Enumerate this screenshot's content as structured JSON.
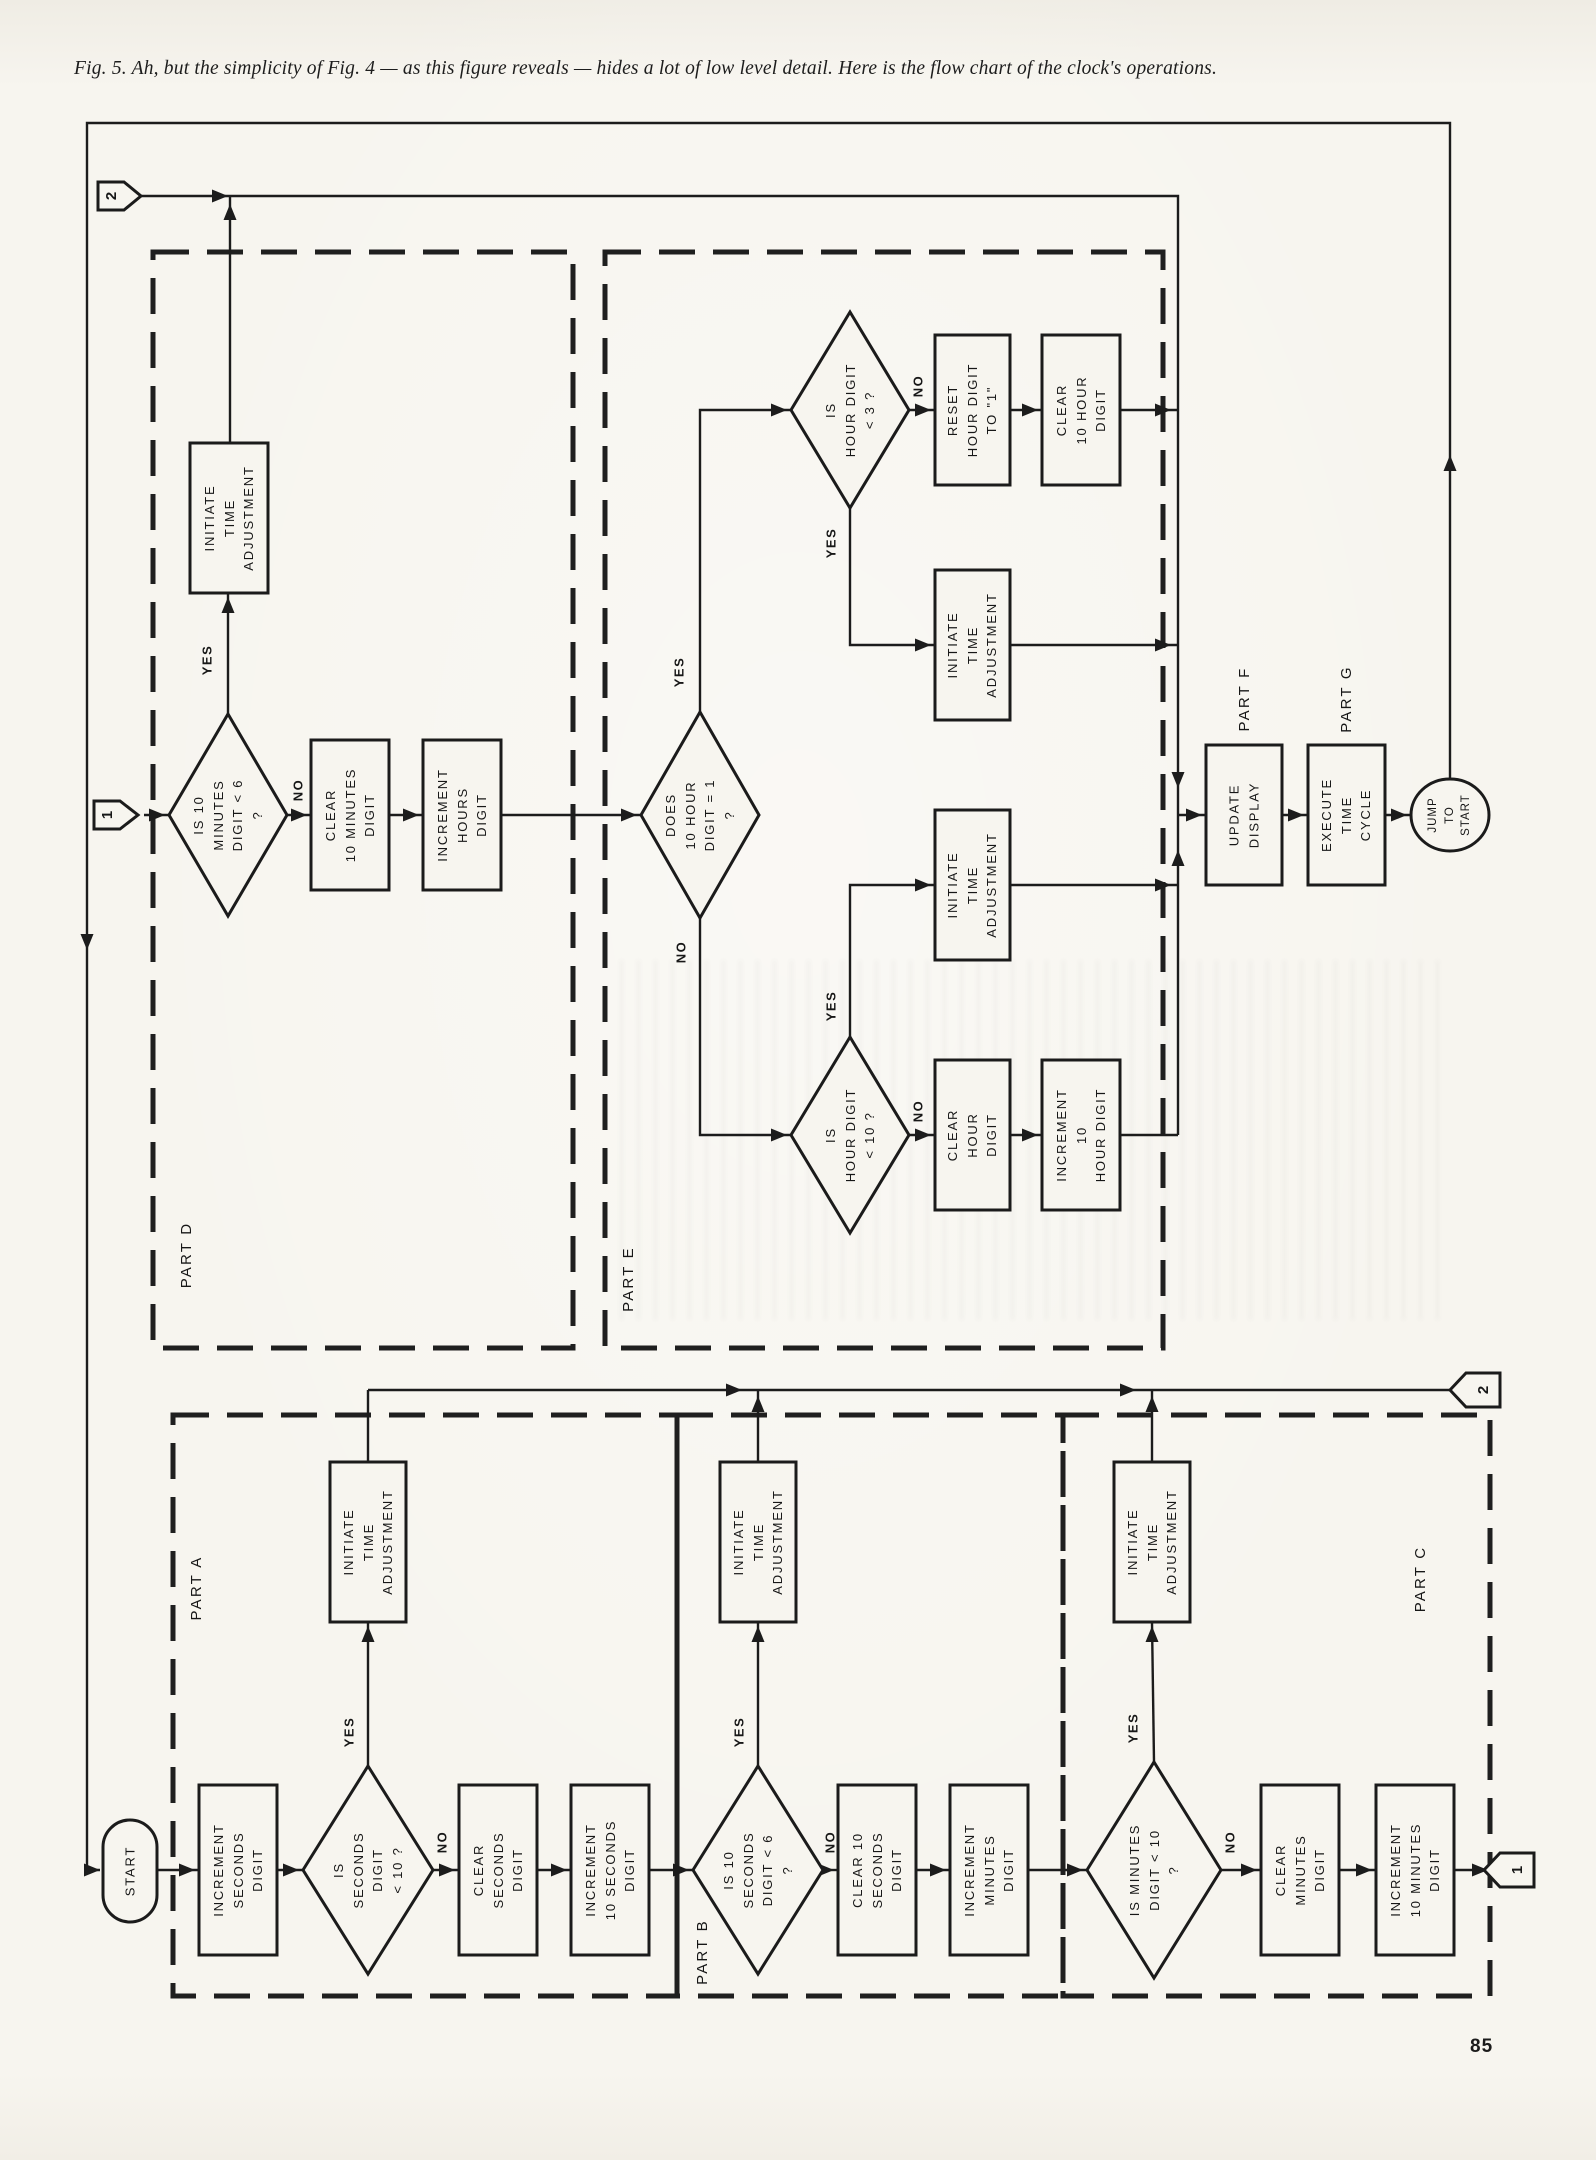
{
  "caption": "Fig. 5. Ah, but the simplicity of Fig. 4 — as this figure reveals — hides a lot of low level detail. Here is the flow chart of the clock's operations.",
  "page_number": "85",
  "decision_labels": {
    "yes": "YES",
    "no": "NO"
  },
  "connectors": {
    "c1": "1",
    "c2": "2"
  },
  "parts": {
    "a": "PART A",
    "b": "PART B",
    "c": "PART C",
    "d": "PART D",
    "e": "PART E",
    "f": "PART F",
    "g": "PART G"
  },
  "nodes": {
    "start": "START",
    "initiate_time_adjustment": "INITIATE\nTIME\nADJUSTMENT",
    "increment_seconds": "INCREMENT\nSECONDS\nDIGIT",
    "is_seconds_lt_10": "IS\nSECONDS\nDIGIT\n< 10 ?",
    "clear_seconds": "CLEAR\nSECONDS\nDIGIT",
    "increment_10_seconds": "INCREMENT\n10 SECONDS\nDIGIT",
    "is_10_seconds_lt_6": "IS 10\nSECONDS\nDIGIT < 6\n?",
    "clear_10_seconds": "CLEAR 10\nSECONDS\nDIGIT",
    "increment_minutes": "INCREMENT\nMINUTES\nDIGIT",
    "is_minutes_lt_10": "IS MINUTES\nDIGIT < 10\n?",
    "clear_minutes": "CLEAR\nMINUTES\nDIGIT",
    "increment_10_minutes": "INCREMENT\n10 MINUTES\nDIGIT",
    "is_10_minutes_lt_6": "IS 10\nMINUTES\nDIGIT < 6\n?",
    "clear_10_minutes": "CLEAR\n10 MINUTES\nDIGIT",
    "increment_hours": "INCREMENT\nHOURS\nDIGIT",
    "does_10_hour_eq_1": "DOES\n10 HOUR\nDIGIT = 1\n?",
    "is_hour_lt_3": "IS\nHOUR DIGIT\n< 3 ?",
    "reset_hour_to_1": "RESET\nHOUR DIGIT\nTO \"1\"",
    "clear_10_hour": "CLEAR\n10 HOUR\nDIGIT",
    "is_hour_lt_10": "IS\nHOUR DIGIT\n< 10 ?",
    "clear_hour": "CLEAR\nHOUR\nDIGIT",
    "increment_10_hour": "INCREMENT\n10\nHOUR DIGIT",
    "update_display": "UPDATE\nDISPLAY",
    "execute_time_cycle": "EXECUTE\nTIME\nCYCLE",
    "jump_to_start": "JUMP\nTO\nSTART"
  }
}
